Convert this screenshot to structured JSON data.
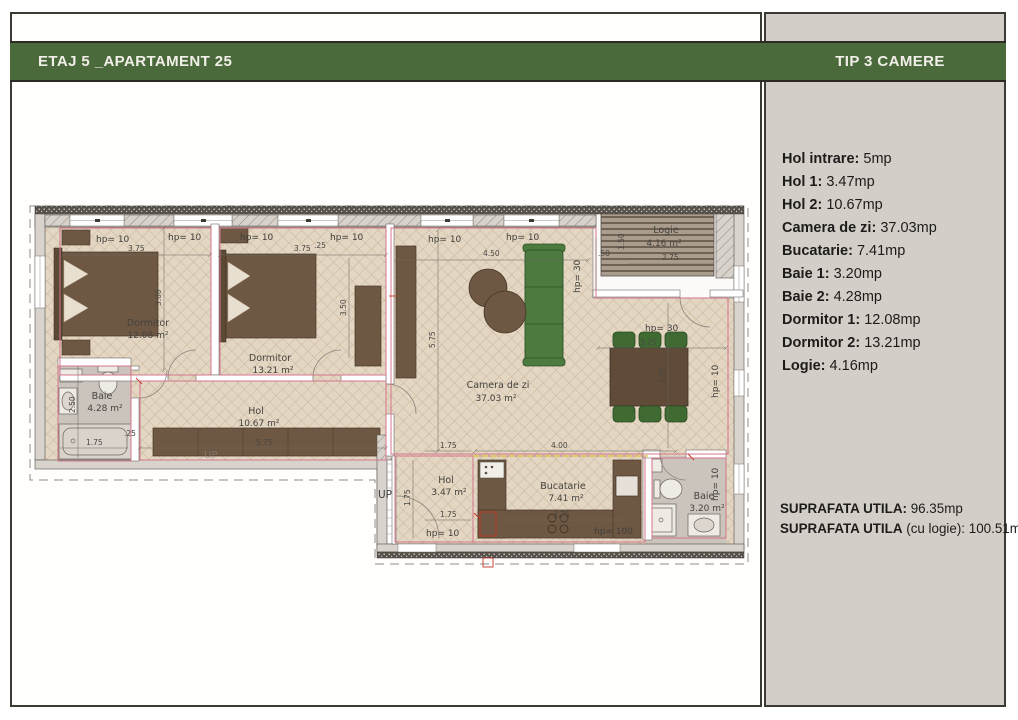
{
  "header": {
    "left_title": "ETAJ 5 _APARTAMENT 25",
    "right_title": "TIP 3 CAMERE"
  },
  "sidebar": {
    "rooms": [
      {
        "label": "Hol intrare:",
        "value": "5mp"
      },
      {
        "label": "Hol 1:",
        "value": "3.47mp"
      },
      {
        "label": "Hol 2:",
        "value": "10.67mp"
      },
      {
        "label": "Camera de zi:",
        "value": "37.03mp"
      },
      {
        "label": "Bucatarie:",
        "value": "7.41mp"
      },
      {
        "label": "Baie 1:",
        "value": "3.20mp"
      },
      {
        "label": "Baie 2:",
        "value": "4.28mp"
      },
      {
        "label": "Dormitor 1:",
        "value": "12.08mp"
      },
      {
        "label": "Dormitor 2:",
        "value": "13.21mp"
      },
      {
        "label": "Logie:",
        "value": "4.16mp"
      }
    ],
    "totals": [
      {
        "label": "SUPRAFATA UTILA:",
        "suffix": "",
        "value": "96.35mp"
      },
      {
        "label": "SUPRAFATA UTILA",
        "suffix": "(cu logie):",
        "value": "100.51mp"
      }
    ]
  },
  "plan": {
    "rooms": {
      "dormitor1": {
        "name": "Dormitor",
        "area": "12.08 m²"
      },
      "dormitor2": {
        "name": "Dormitor",
        "area": "13.21 m²"
      },
      "camera_de_zi": {
        "name": "Camera de zi",
        "area": "37.03 m²"
      },
      "logie": {
        "name": "Logie",
        "area": "4.16 m²"
      },
      "baie2": {
        "name": "Baie",
        "area": "4.28 m²"
      },
      "hol2": {
        "name": "Hol",
        "area": "10.67 m²"
      },
      "hol1": {
        "name": "Hol",
        "area": "3.47 m²"
      },
      "bucatarie": {
        "name": "Bucatarie",
        "area": "7.41 m²"
      },
      "baie1": {
        "name": "Baie",
        "area": "3.20 m²"
      }
    },
    "labels": {
      "hp10": "hp= 10",
      "hp30": "hp= 30",
      "hp100": "hp= 100",
      "up": "UP"
    },
    "dims": {
      "d375": "3.75",
      "d300": "3.00",
      "d350": "3.50",
      "d450": "4.50",
      "d275": "2.75",
      "d575": "5.75",
      "d150": "1.50",
      "d050": ".50",
      "d250": "2.50",
      "d175": "1.75",
      "d025": ".25",
      "d400": "4.00",
      "d325": "3.25"
    }
  },
  "colors": {
    "accent_green": "#4a6a3c",
    "sidebar_bg": "#d3cec8",
    "floor_beige": "#e3d6c2",
    "furniture_brown": "#6e5843",
    "sofa_green": "#4c7a3f",
    "room_outline_pink": "#d4748c"
  }
}
